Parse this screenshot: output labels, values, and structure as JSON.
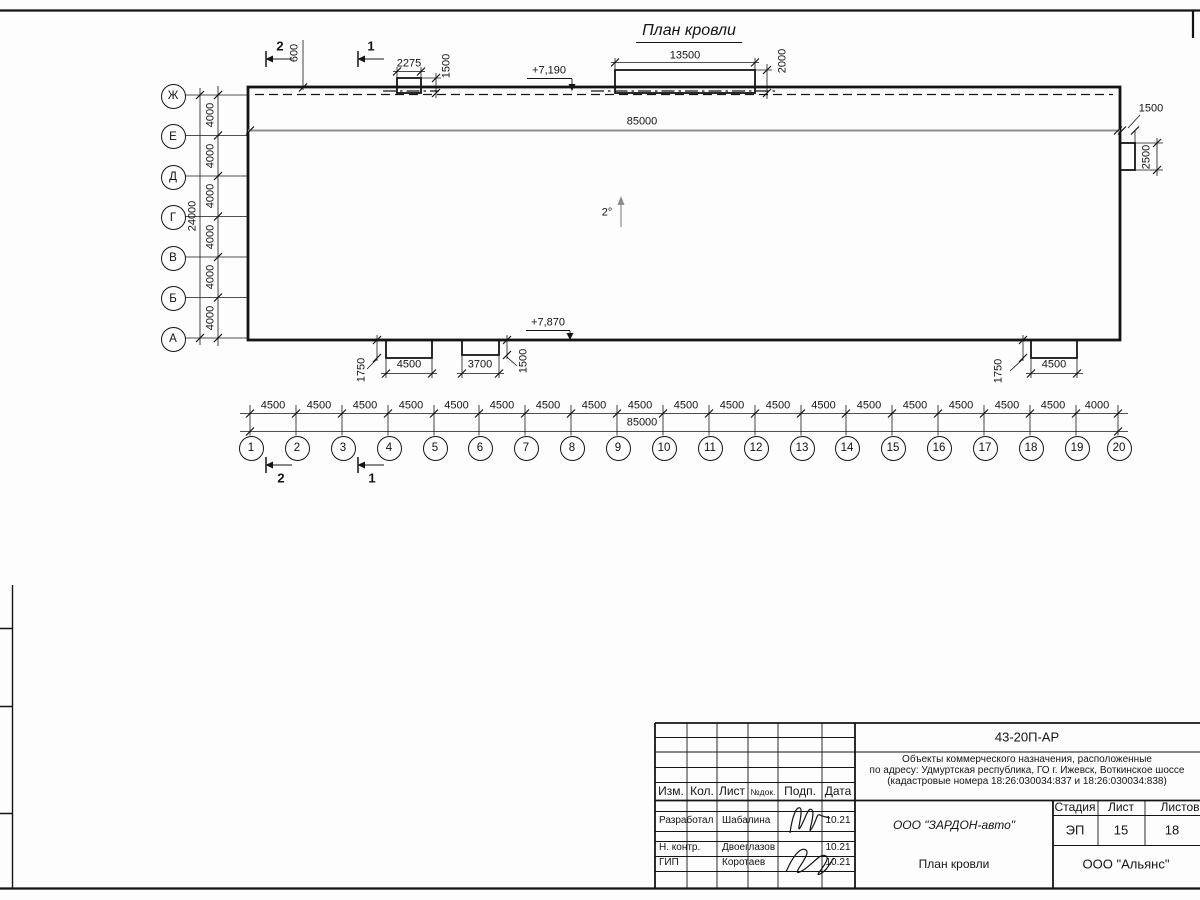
{
  "title": "План кровли",
  "axes": {
    "rows": [
      "Ж",
      "Е",
      "Д",
      "Г",
      "В",
      "Б",
      "А"
    ],
    "columns": [
      "1",
      "2",
      "3",
      "4",
      "5",
      "6",
      "7",
      "8",
      "9",
      "10",
      "11",
      "12",
      "13",
      "14",
      "15",
      "16",
      "17",
      "18",
      "19",
      "20"
    ]
  },
  "dimensions": {
    "left": {
      "segments": [
        "4000",
        "4000",
        "4000",
        "4000",
        "4000",
        "4000"
      ],
      "total": "24000"
    },
    "bottom": {
      "segments": [
        "4500",
        "4500",
        "4500",
        "4500",
        "4500",
        "4500",
        "4500",
        "4500",
        "4500",
        "4500",
        "4500",
        "4500",
        "4500",
        "4500",
        "4500",
        "4500",
        "4500",
        "4500",
        "4000"
      ],
      "total": "85000"
    },
    "roof_length": "85000",
    "top_offset": "600",
    "skylight_small": {
      "width": "2275",
      "depth": "1500"
    },
    "skylight_large": {
      "width": "13500",
      "depth": "2000"
    },
    "canopy_right": {
      "width": "1500",
      "height": "2500"
    },
    "canopy_bottom_1": {
      "width": "4500",
      "depth": "1750"
    },
    "canopy_bottom_2": {
      "width": "3700",
      "depth": "1500"
    },
    "canopy_bottom_3": {
      "width": "4500",
      "depth": "1750"
    }
  },
  "elevations": {
    "roof_high": "+7,190",
    "roof_low": "+7,870"
  },
  "slope": "2°",
  "sections": {
    "one": "1",
    "two": "2"
  },
  "title_block": {
    "doc_number": "43-20П-АР",
    "description_line1": "Объекты коммерческого назначения, расположенные",
    "description_line2": "по адресу: Удмуртская республика, ГО г. Ижевск, Воткинское шоссе",
    "description_line3": "(кадастровые номера 18:26:030034:837 и 18:26:030034:838)",
    "header": {
      "izm": "Изм.",
      "kol": "Кол.",
      "list": "Лист",
      "doc": "№док.",
      "podp": "Подп.",
      "data": "Дата"
    },
    "rows": [
      {
        "role": "Разработал",
        "name": "Шабалина",
        "date": "10.21"
      },
      {
        "role": "Н. контр.",
        "name": "Двоеглазов",
        "date": "10.21"
      },
      {
        "role": "ГИП",
        "name": "Коротаев",
        "date": "10.21"
      }
    ],
    "company": "ООО \"ЗАРДОН-авто\"",
    "sheet_title": "План кровли",
    "org": "ООО \"Альянс\"",
    "stage_label": "Стадия",
    "stage": "ЭП",
    "sheet_label": "Лист",
    "sheet": "15",
    "sheets_label": "Листов",
    "sheets": "18"
  }
}
